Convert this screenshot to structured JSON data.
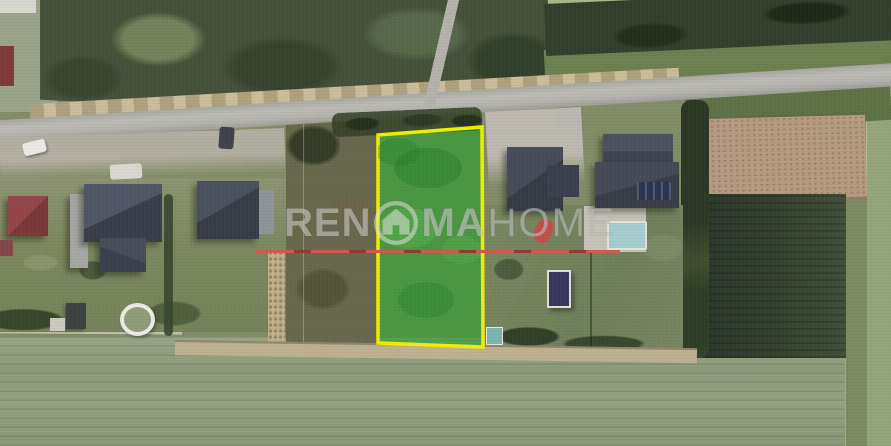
{
  "watermark": {
    "prefix": "REN",
    "mid": "MA",
    "suffix": "HOME",
    "icon": "house-in-circle-icon",
    "color": "rgba(230,230,228,0.5)"
  },
  "parcel": {
    "points": "378,135 482,127 483,347 378,343",
    "outline_color": "#f2ee00",
    "fill_color": "rgba(40,158,44,0.62)"
  },
  "red_boundary_line": {
    "y_px": 251,
    "x_start_px": 257,
    "x_end_px": 620,
    "color": "#d2574c",
    "dash_color": "#8f3a33"
  }
}
